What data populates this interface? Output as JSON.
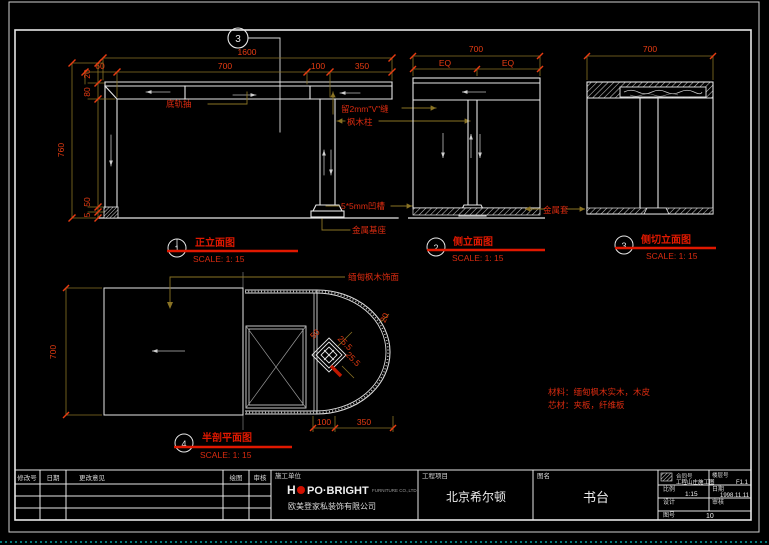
{
  "views": {
    "front": {
      "callout_num": "3",
      "num": "1",
      "title": "正立面图",
      "scale": "SCALE: 1: 15",
      "dims": {
        "total": "1600",
        "d60": "60",
        "d700": "700",
        "d100": "100",
        "d350": "350",
        "d20": "20",
        "d80": "80",
        "d760": "760",
        "d50": "50",
        "d5": "5"
      },
      "labels": {
        "drawer": "底轨抽",
        "vgroove": "留2mm\"V\"缝",
        "post": "枫木柱",
        "groove": "5*5mm凹槽",
        "base": "金属基座"
      }
    },
    "side": {
      "num": "2",
      "title": "侧立面图",
      "scale": "SCALE: 1: 15",
      "dims": {
        "total": "700",
        "eq1": "EQ",
        "eq2": "EQ"
      },
      "label_base": "金属套"
    },
    "sidecut": {
      "num": "3",
      "title": "侧切立面图",
      "scale": "SCALE: 1: 15",
      "dims": {
        "total": "700"
      }
    },
    "plan": {
      "num": "4",
      "title": "半剖平面图",
      "scale": "SCALE: 1: 15",
      "dims": {
        "depth": "700",
        "d100": "100",
        "d350": "350",
        "d20": "20",
        "d50": "50",
        "d255a": "25.5",
        "d255b": "25.5"
      },
      "label_finish": "缅甸枫木饰面"
    }
  },
  "notes": {
    "line1": "材料：缅甸枫木实木，木皮",
    "line2": "芯材：夹板，纤维板"
  },
  "titleblock": {
    "rev_headers": {
      "h1": "修改号",
      "h2": "日期",
      "h3": "更改意见",
      "h4": "绘图",
      "h5": "审核"
    },
    "contractor_label": "施工单位",
    "logo": {
      "h": "H",
      "rest": "PO·BRIGHT",
      "sub": "FURNITURE CO.,LTD"
    },
    "company_cn": "欧美登家私装饰有限公司",
    "project_label": "工程项目",
    "project": "北京希尔顿",
    "sheet_label": "图名",
    "sheet": "书台",
    "info": {
      "r1l_label": "合同号",
      "r1l_value": "工程山庄施工图",
      "r1r_label": "楼层号",
      "r1r_value": "F1.1",
      "scale_label": "比例",
      "scale_value": "1:15",
      "date_label": "日期",
      "date_value": "1998.11.11",
      "design_label": "设计",
      "design_value": "",
      "check_label": "审核",
      "check_value": "",
      "no_label": "图号",
      "no_value": "10"
    }
  },
  "colors": {
    "dimline": "#8a7324",
    "dimtext": "#e83c12",
    "white": "#e6e6e6",
    "cyan": "#00a0a0"
  }
}
